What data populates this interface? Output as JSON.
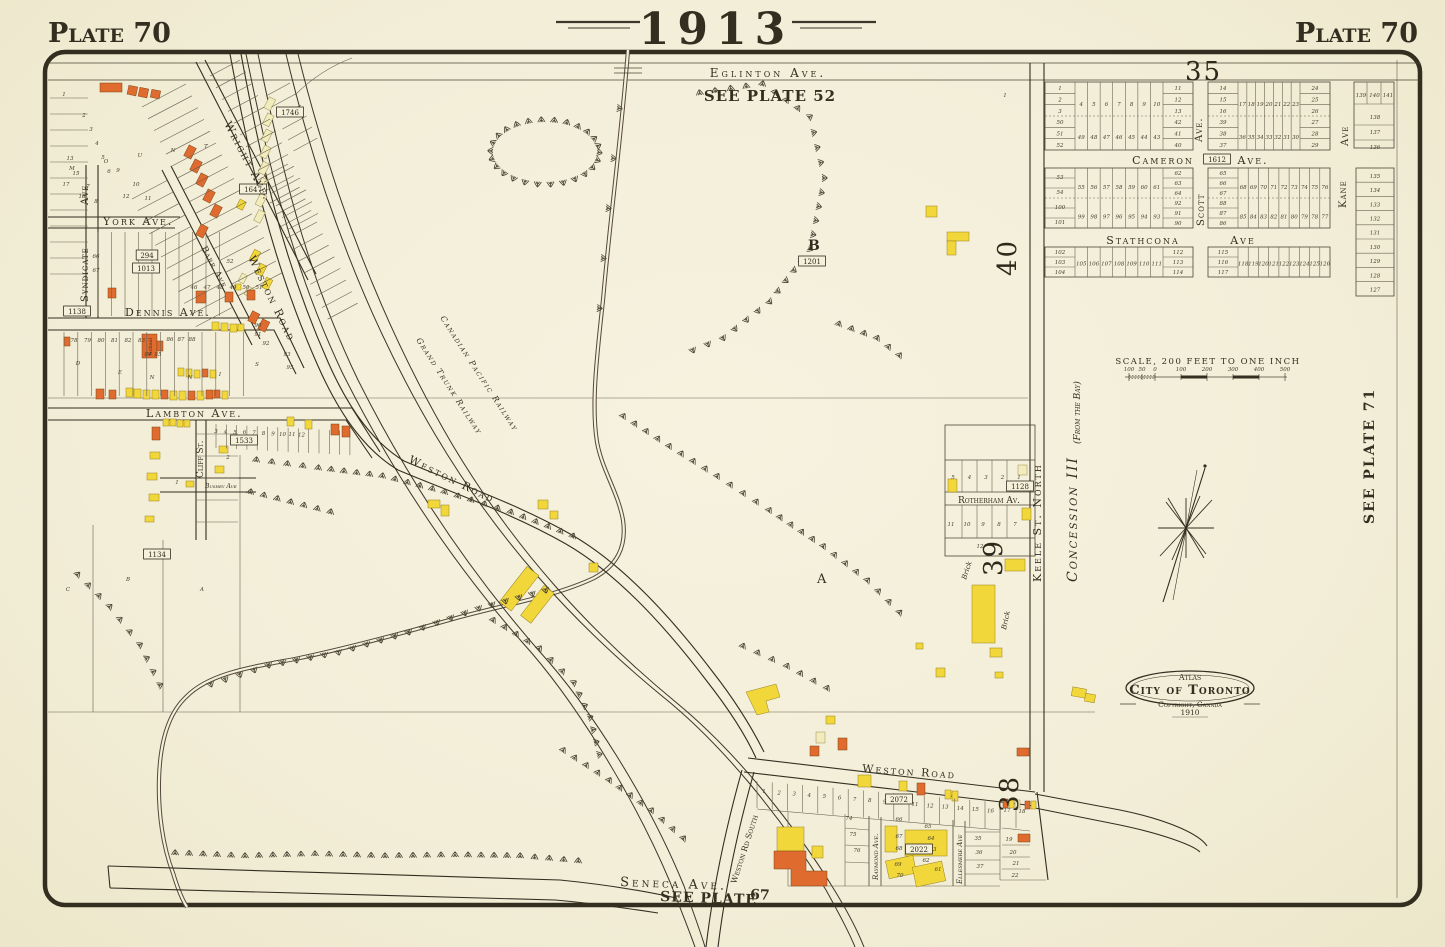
{
  "colors": {
    "paper": "#f4f0da",
    "ink": "#332e20",
    "light_line": "#6a6250",
    "building_orange": "#df6b2f",
    "building_yellow": "#f2d73b",
    "building_pale": "#f1ebbd",
    "creek": "#54483a"
  },
  "header": {
    "year": "1913",
    "plate_left": "Plate 70",
    "plate_right": "Plate 70"
  },
  "references": {
    "plate52": "SEE PLATE 52",
    "plate71": "SEE PLATE 71",
    "plate67_text": "SEE PLATE",
    "plate67_num": "67"
  },
  "streets": {
    "eglinton": "Eglinton Ave.",
    "wright": "Wright Ave.",
    "barr": "Barr Ave",
    "weston_nw": "Weston Road",
    "weston_mid": "Weston Road",
    "weston_bottom": "Weston Road",
    "weston_south": "Weston Rd South",
    "york": "York Ave.",
    "dennis": "Dennis Ave.",
    "lambton": "Lambton Ave.",
    "cliff": "Cliff St.",
    "bushey": "Bushey Ave",
    "syndicate": "Syndicate",
    "ave_fragment": "Ave",
    "seneca": "Seneca Ave.",
    "cameron": "Cameron",
    "cameron_ave": "Ave.",
    "stathcona": "Stathcona",
    "stathcona_ave": "Ave",
    "scott": "Scott",
    "scott_ave": "Ave.",
    "kane": "Kane",
    "kane_ave": "Ave",
    "keele": "Keele St. North",
    "rotherham": "Rotherham Av.",
    "raymond": "Raymond Ave.",
    "ellesmere": "Ellesmere Ave"
  },
  "railways": {
    "cpr": "Canadian Pacific Railway",
    "gtr": "Grand Trunk Railway"
  },
  "district": {
    "concession": "Concession III",
    "from_bay": "(From the Bay)",
    "mount": [
      "M",
      "O",
      "U",
      "N",
      "T"
    ],
    "dennis": [
      "D",
      "E",
      "N",
      "N",
      "I",
      "S"
    ],
    "sub_lots": [
      "C",
      "B",
      "A"
    ],
    "big_b": "B",
    "big_a": "A"
  },
  "sections": {
    "n35": "35",
    "n38": "38",
    "n39": "39",
    "n40": "40"
  },
  "plans": {
    "p1746": "1746",
    "p1647": "1647",
    "p294": "294",
    "p1013": "1013",
    "p1138": "1138",
    "p1533": "1533",
    "p1134": "1134",
    "p1201": "1201",
    "p1612": "1612",
    "p1128": "1128",
    "p2072": "2072",
    "p2022": "2022"
  },
  "scale": {
    "caption": "SCALE, 200 FEET TO ONE INCH",
    "ticks": [
      "100",
      "50",
      "0",
      "100",
      "200",
      "300",
      "400",
      "500"
    ]
  },
  "stamp": {
    "atlas": "Atlas",
    "city": "City of Toronto",
    "copyright": "Copyright, Canada",
    "year": "1910"
  },
  "annotations": {
    "school": "School",
    "brick_a": "Brick",
    "brick_b": "Brick"
  },
  "lots": {
    "a1_left_top": [
      "1",
      "2",
      "3"
    ],
    "a1_left_bot": [
      "50",
      "51",
      "52"
    ],
    "a1_mid_top": [
      "4",
      "5",
      "6",
      "7",
      "8",
      "9",
      "10"
    ],
    "a1_mid_bot": [
      "49",
      "48",
      "47",
      "46",
      "45",
      "44",
      "43"
    ],
    "a1_right_top": [
      "11",
      "12",
      "13"
    ],
    "a1_right_bot": [
      "42",
      "41",
      "40"
    ],
    "b1_left_top": [
      "14",
      "15",
      "16"
    ],
    "b1_left_bot": [
      "39",
      "38",
      "37"
    ],
    "b1_mid_top": [
      "17",
      "18",
      "19",
      "20",
      "21",
      "22",
      "23"
    ],
    "b1_mid_bot": [
      "36",
      "35",
      "34",
      "33",
      "32",
      "31",
      "30"
    ],
    "b1_right_top": [
      "24",
      "25",
      "26"
    ],
    "b1_right_bot": [
      "27",
      "28",
      "29"
    ],
    "a2_left_top": [
      "53",
      "54"
    ],
    "a2_left_bot": [
      "100",
      "101"
    ],
    "a2_mid_top": [
      "55",
      "56",
      "57",
      "58",
      "59",
      "60",
      "61"
    ],
    "a2_mid_bot": [
      "99",
      "98",
      "97",
      "96",
      "95",
      "94",
      "93"
    ],
    "a2_right_top": [
      "62",
      "63",
      "64"
    ],
    "a2_right_bot": [
      "92",
      "91",
      "90"
    ],
    "b2_left_top": [
      "65",
      "66",
      "67"
    ],
    "b2_left_bot": [
      "88",
      "87",
      "86"
    ],
    "b2_mid_top": [
      "68",
      "69",
      "70",
      "71",
      "72",
      "73",
      "74",
      "75",
      "76"
    ],
    "b2_mid_bot": [
      "85",
      "84",
      "83",
      "82",
      "81",
      "80",
      "79",
      "78",
      "77"
    ],
    "a3_left": [
      "102",
      "103",
      "104"
    ],
    "a3_mid": [
      "105",
      "106",
      "107",
      "108",
      "109",
      "110",
      "111"
    ],
    "a3_right": [
      "112",
      "113",
      "114"
    ],
    "b3_left": [
      "115",
      "116",
      "117"
    ],
    "b3_mid": [
      "118",
      "119",
      "120",
      "121",
      "122",
      "123",
      "124",
      "125",
      "126"
    ],
    "e1_row": [
      "139",
      "140",
      "141"
    ],
    "e1_col": [
      "138",
      "137",
      "136"
    ],
    "e2_col": [
      "135",
      "134",
      "133",
      "132",
      "131",
      "130",
      "129",
      "128",
      "127"
    ],
    "stray": [
      "1"
    ],
    "md_scatter": [
      "1",
      "2",
      "3",
      "4",
      "5",
      "6",
      "7",
      "8",
      "9",
      "10",
      "11",
      "12",
      "13",
      "15",
      "17",
      "18"
    ],
    "york_row": [
      "46",
      "47",
      "48",
      "49",
      "50",
      "51"
    ],
    "york_extra": [
      "66",
      "67",
      "52"
    ],
    "dennis_row": [
      "78",
      "79",
      "80",
      "81",
      "82",
      "83"
    ],
    "dennis_mid": [
      "86",
      "87",
      "88"
    ],
    "dennis_pair": [
      "84",
      "85"
    ],
    "dennis_right": [
      "90",
      "91",
      "92",
      "93",
      "95"
    ],
    "lambton_row": [
      "3",
      "4",
      "5",
      "6",
      "7",
      "8",
      "9",
      "10",
      "11",
      "12"
    ],
    "lambton_extra": [
      "2",
      "1"
    ],
    "rotherham_top": [
      "5",
      "4",
      "3",
      "2",
      "1"
    ],
    "rotherham_bot": [
      "11",
      "10",
      "9",
      "8",
      "7"
    ],
    "rotherham_extra": "12",
    "weston_strip": [
      "1",
      "2",
      "3",
      "4",
      "5",
      "6",
      "7",
      "8",
      "9",
      "10",
      "11",
      "12",
      "13",
      "14",
      "15",
      "16",
      "17",
      "18"
    ],
    "strip_south": [
      "74",
      "75",
      "76"
    ],
    "raymond_block": [
      "66",
      "65",
      "64",
      "67",
      "68",
      "69",
      "70",
      "61",
      "62",
      "63"
    ],
    "mid_col": [
      "35",
      "36",
      "37"
    ],
    "east_col": [
      "19",
      "20",
      "21",
      "22"
    ]
  }
}
